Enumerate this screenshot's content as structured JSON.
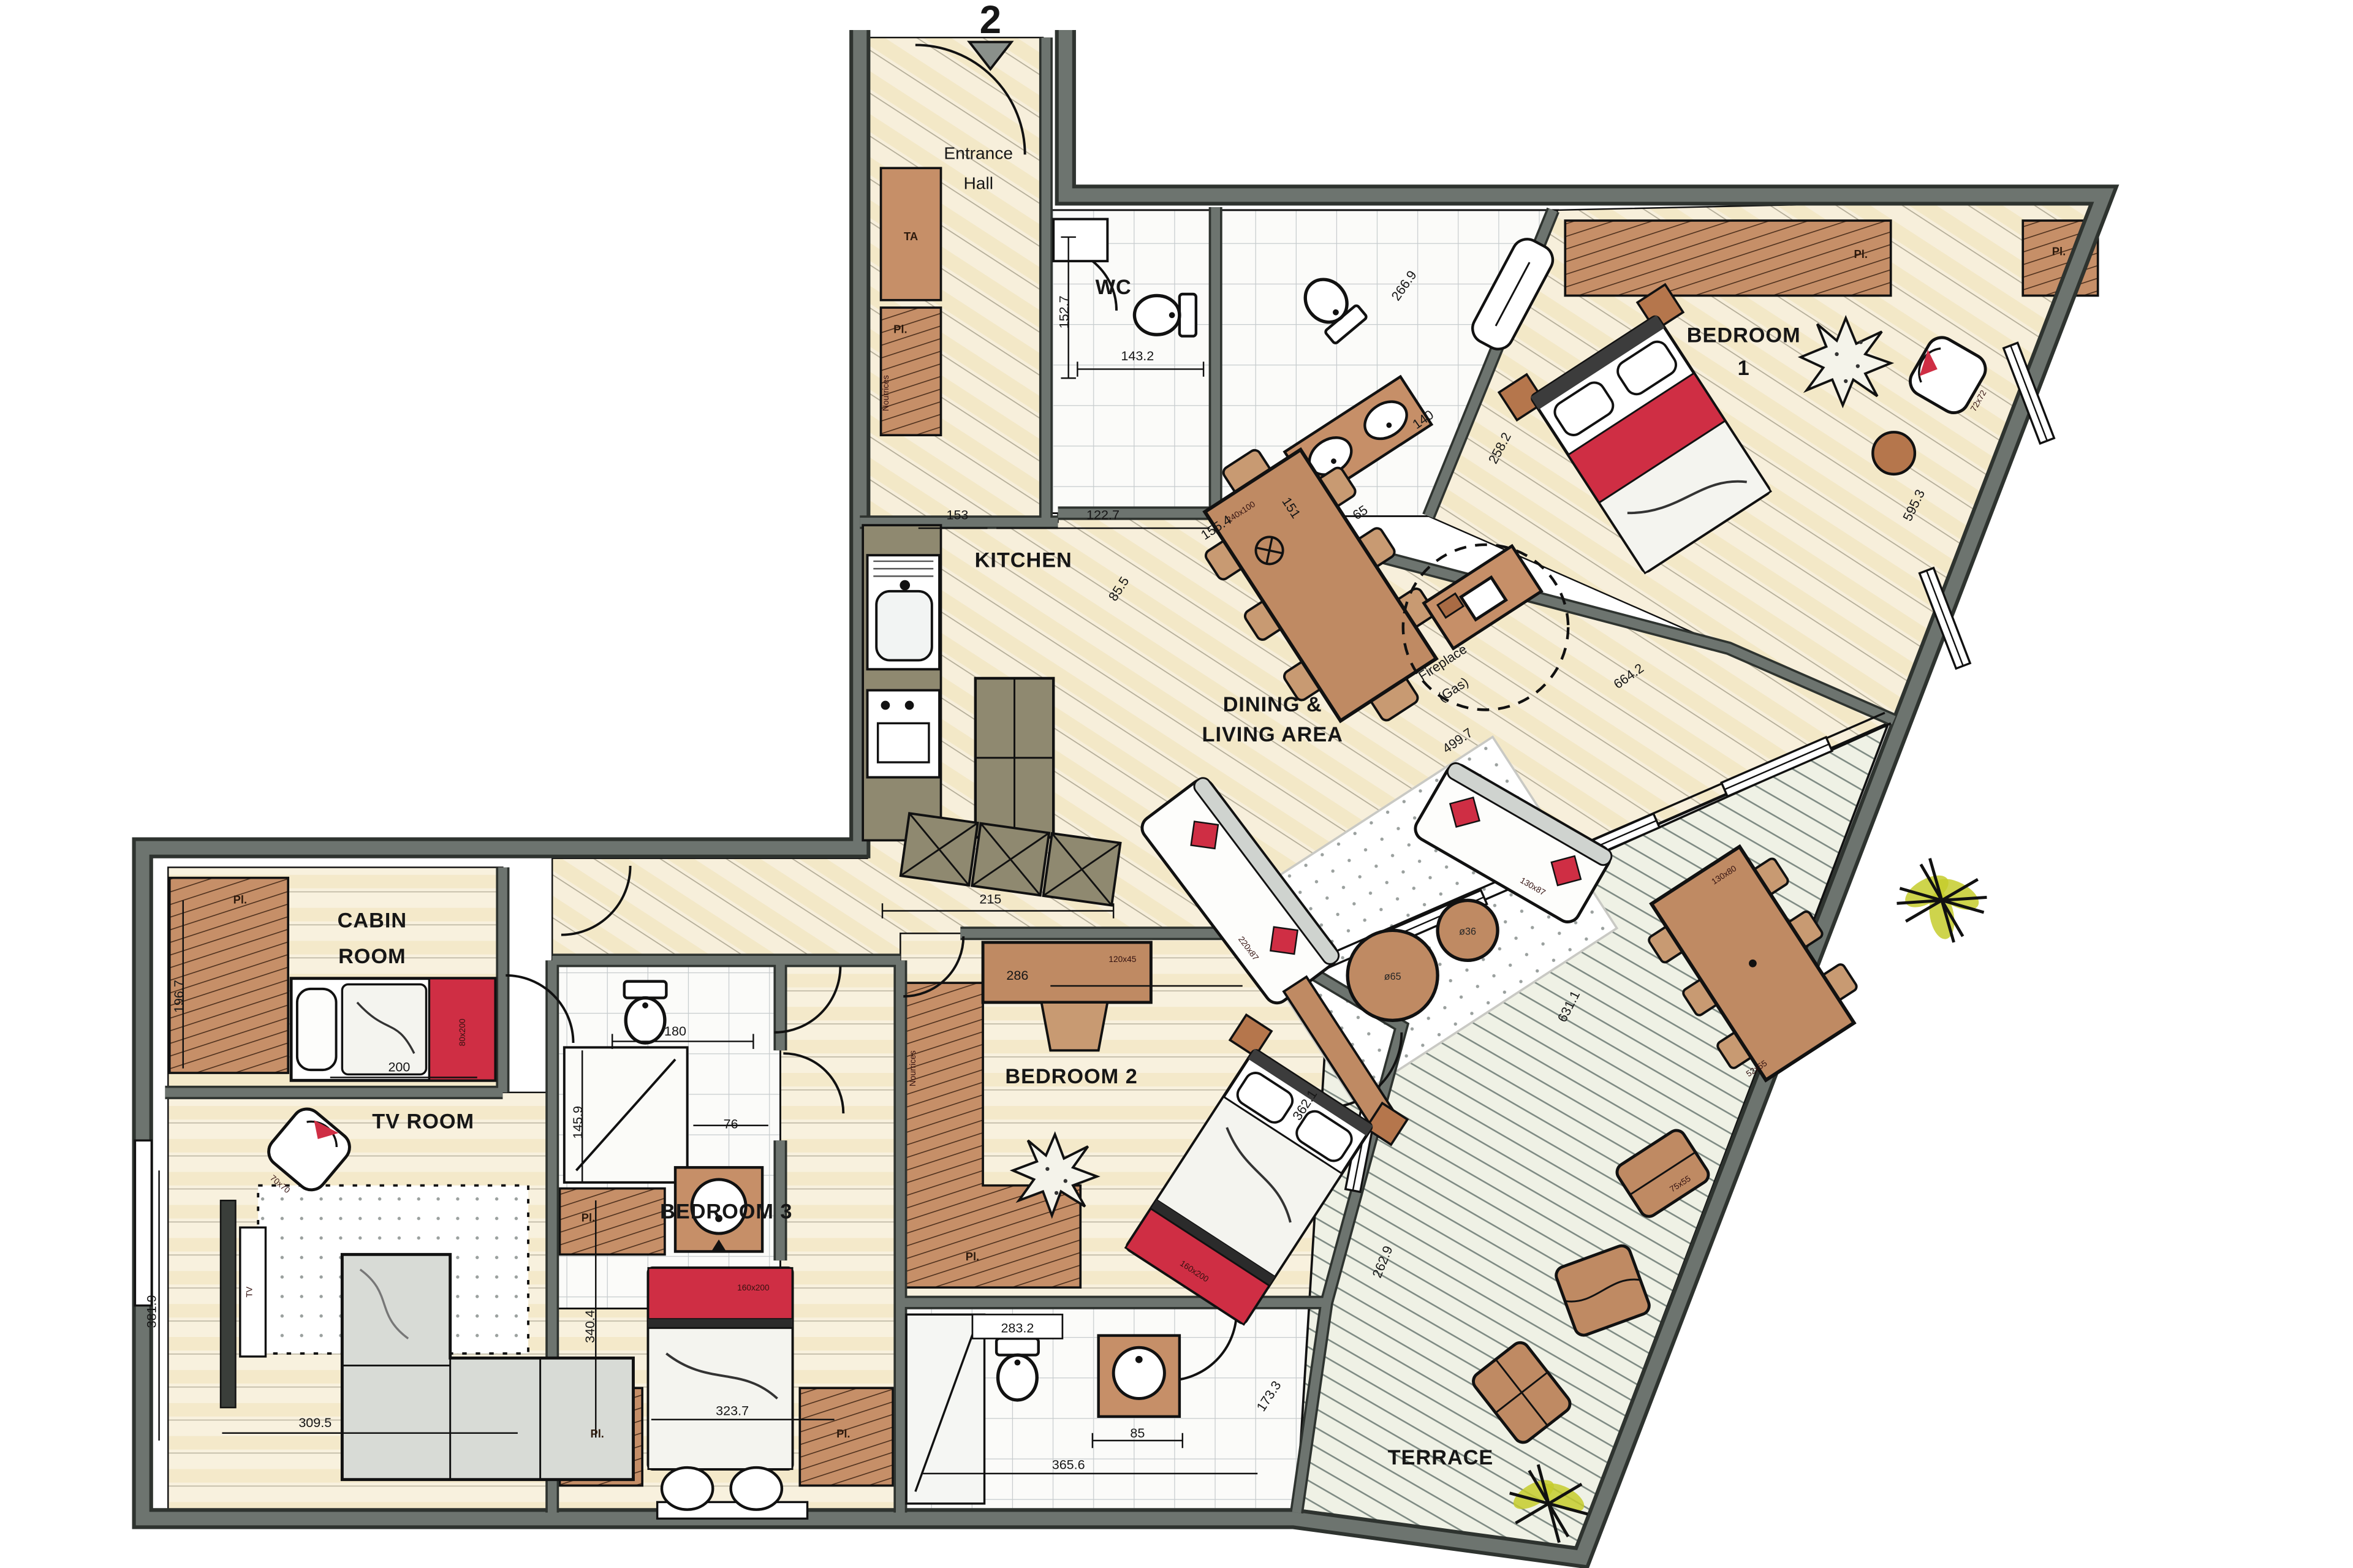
{
  "plan": {
    "floor_number": "2",
    "rooms": {
      "entrance_1": "Entrance",
      "entrance_2": "Hall",
      "wc": "WC",
      "kitchen": "KITCHEN",
      "dining_1": "DINING &",
      "dining_2": "LIVING AREA",
      "bedroom1_1": "BEDROOM",
      "bedroom1_2": "1",
      "bedroom2": "BEDROOM 2",
      "bedroom3": "BEDROOM 3",
      "tv_room": "TV ROOM",
      "cabin_1": "CABIN",
      "cabin_2": "ROOM",
      "terrace": "TERRACE"
    },
    "annotations": {
      "closet": "Pl.",
      "ta": "TA",
      "manifolds": "Nourrices",
      "tv": "TV",
      "fireplace_1": "Fireplace",
      "fireplace_2": "(Gas)"
    },
    "furniture": {
      "dining_table": "240x100",
      "sofa_large": "220x87",
      "sofa_small": "130x87",
      "coffee_large": "ø65",
      "coffee_small": "ø36",
      "desk": "120x45",
      "bed_double": "160x200",
      "cabin_bed": "80x200",
      "armchair_bedroom1": "72x72",
      "armchair_tv": "70x70",
      "terrace_table": "130x80",
      "terrace_chair": "52x55",
      "terrace_lounger": "75x55"
    },
    "dimensions": {
      "wc_depth": "152.7",
      "wc_width": "143.2",
      "bath1_width": "266.9",
      "bath1_vanity": "140",
      "bath1_depth": "258.2",
      "bedroom1_wall": "595.3",
      "kitchen_counter": "153",
      "kitchen_island": "122.7",
      "kitchen_diag": "85.5",
      "dining_table_len": "155.4",
      "dining_width": "151",
      "dining_chair": "65",
      "living_diag1": "499.7",
      "living_diag2": "664.2",
      "living_diag3": "631.1",
      "hall_width": "215",
      "bedroom2_width": "286",
      "bed2_len": "362.1",
      "bedroom2_wall": "262.9",
      "cabin_closet": "196.7",
      "cabin_bed_len": "200",
      "bath3_width": "180",
      "bath3_shower": "145.9",
      "bath3_door": "76",
      "tvroom_depth": "381.9",
      "tvroom_width": "309.5",
      "bedroom3_depth": "340.4",
      "bedroom3_width": "323.7",
      "bath2_width": "283.2",
      "bath2_vanity": "85",
      "bath2_len": "365.6",
      "bath2_door": "173.3"
    }
  }
}
